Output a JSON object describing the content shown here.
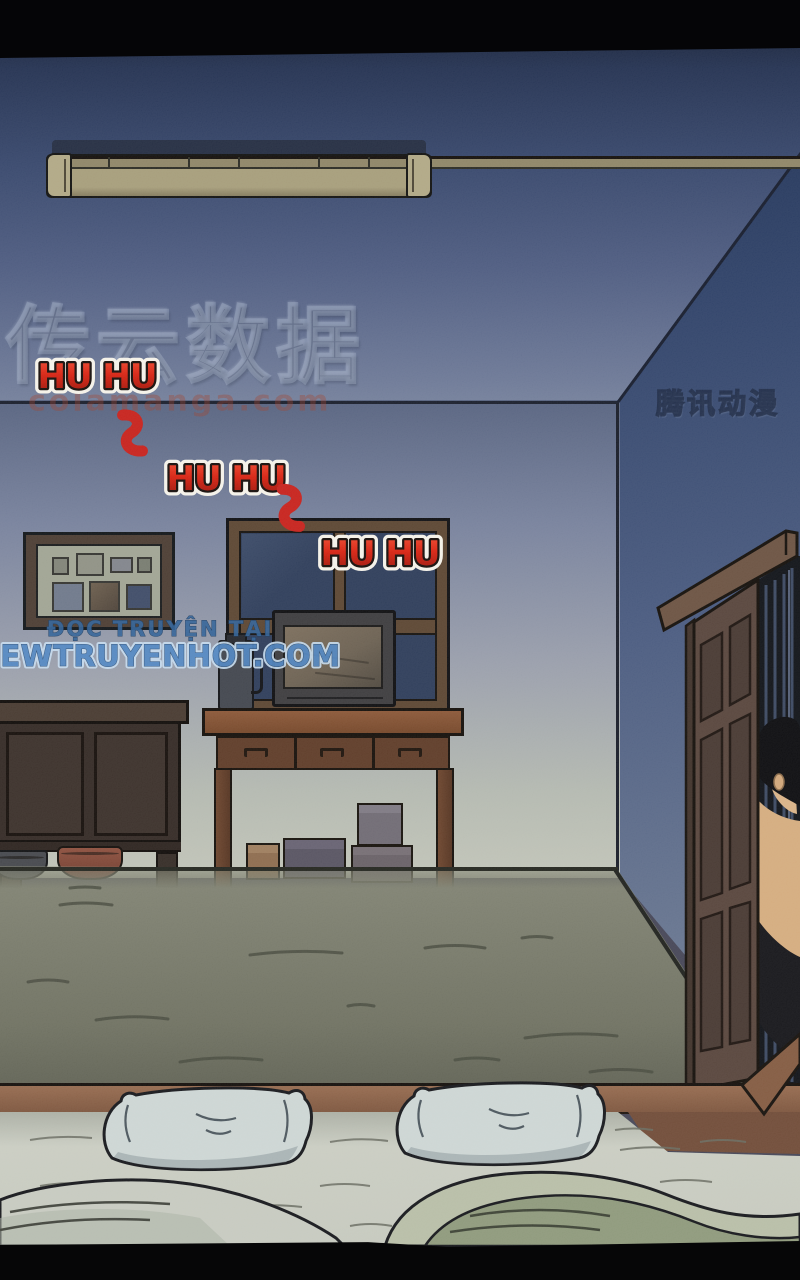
{
  "panel": {
    "type": "comic-page-panel",
    "scene": "dark bedroom at night: ceiling lamp, photo frame, window with TV on a desk, sideboard with basins, open door with a man peeking in, twin pillows on a bed in the foreground",
    "sfx": [
      "HU HU",
      "HU HU",
      "HU HU"
    ],
    "watermarks": {
      "embossed_text": "传云数据",
      "site_domain": "colamanga.com",
      "publisher_logo": "腾讯动漫"
    },
    "promo": {
      "line1": "ĐỌC TRUYỆN TẠI",
      "line2": "NEWTRUYENHOT.COM"
    },
    "colors": {
      "sfx_red": "#cf1d10",
      "sfx_outline": "#f4f1e8",
      "promo_blue": "#4d85c3",
      "promo_dark_blue": "#2f6096",
      "night_wall_blue": "#45597e",
      "wood_brown": "#7c4b2e",
      "floor_gray_green": "#7e8070"
    }
  }
}
